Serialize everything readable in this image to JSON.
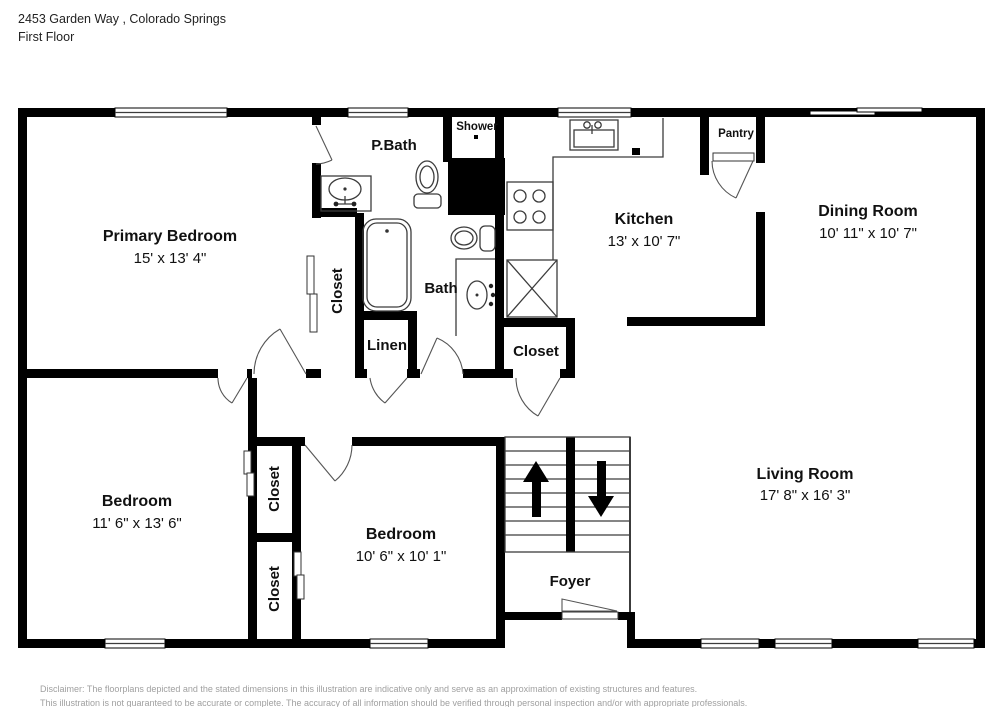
{
  "header": {
    "address_line": "2453 Garden Way , Colorado Springs",
    "floor_line": "First Floor"
  },
  "rooms": {
    "primary_bedroom": {
      "name": "Primary Bedroom",
      "dims": "15' x 13' 4\""
    },
    "kitchen": {
      "name": "Kitchen",
      "dims": "13' x 10' 7\""
    },
    "dining_room": {
      "name": "Dining Room",
      "dims": "10' 11\" x 10' 7\""
    },
    "living_room": {
      "name": "Living Room",
      "dims": "17' 8\" x 16' 3\""
    },
    "bedroom_left": {
      "name": "Bedroom",
      "dims": "11' 6\" x 13' 6\""
    },
    "bedroom_middle": {
      "name": "Bedroom",
      "dims": "10' 6\" x 10' 1\""
    }
  },
  "small_rooms": {
    "p_bath": "P.Bath",
    "shower": "Shower",
    "bath": "Bath",
    "linen": "Linen",
    "pantry": "Pantry",
    "foyer": "Foyer",
    "closet_primary": "Closet",
    "closet_hall": "Closet",
    "closet_left_upper": "Closet",
    "closet_left_lower": "Closet"
  },
  "footer": {
    "line1": "Disclaimer: The floorplans depicted and the stated dimensions in this illustration are indicative only and serve as an approximation of existing structures and features.",
    "line2": "This illustration is not guaranteed to be accurate or complete. The accuracy of all information should be verified through personal inspection and/or with appropriate professionals."
  }
}
